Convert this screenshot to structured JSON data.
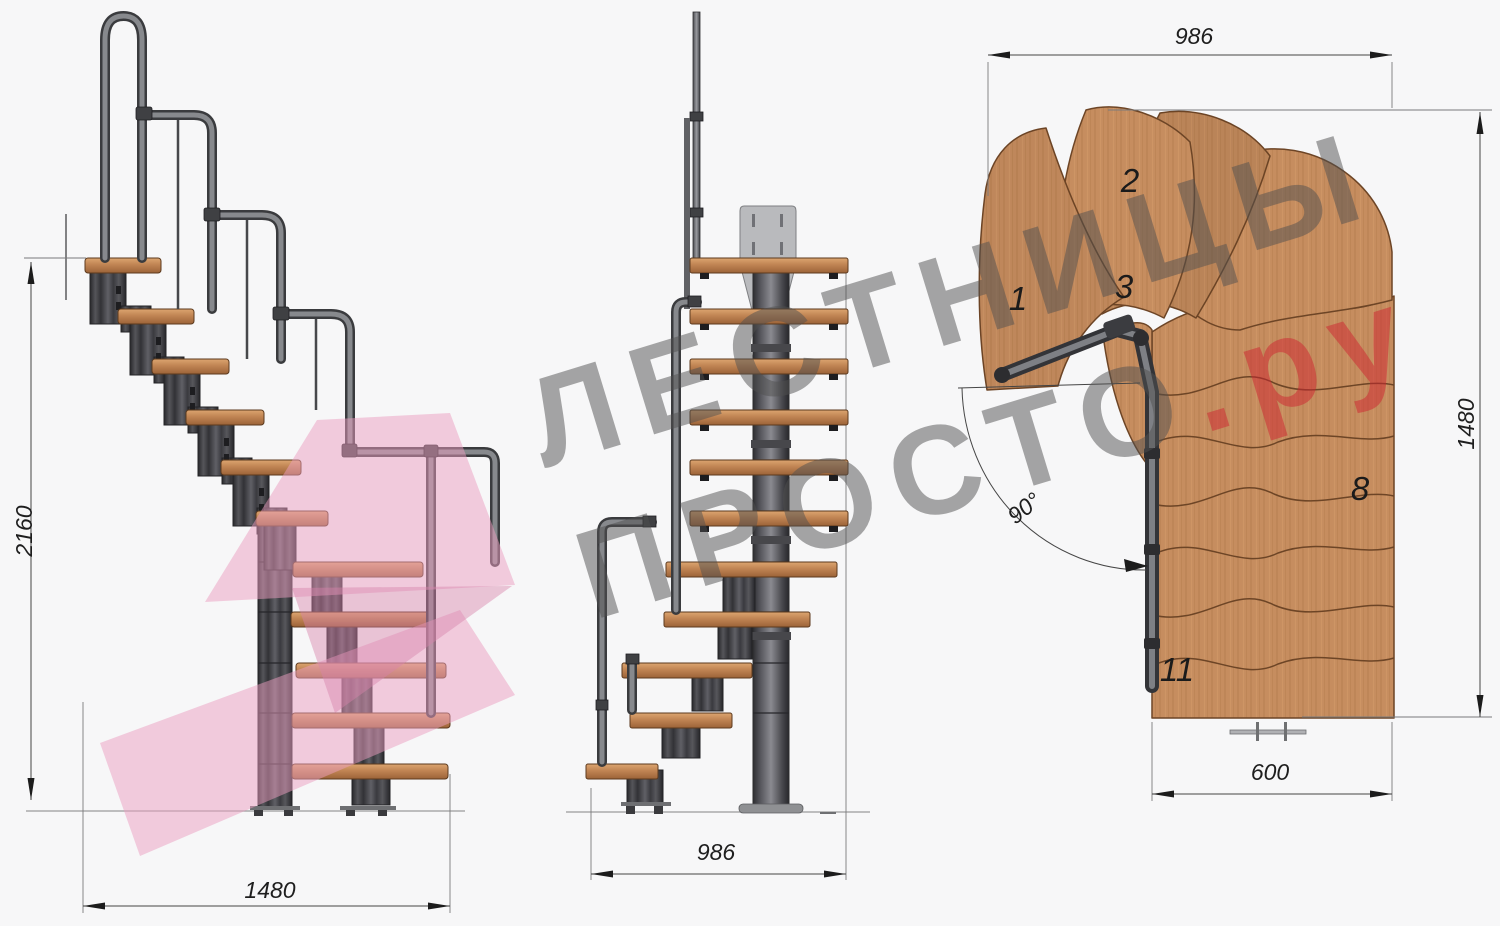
{
  "watermark": {
    "line1": "ЛЕСТНИЦЫ",
    "line2_gray": "ПРОСТО",
    "line2_red": ".ру"
  },
  "dims": {
    "side_height": "2160",
    "side_width": "1480",
    "front_width": "986",
    "plan_width": "986",
    "plan_depth": "1480",
    "plan_tread_width": "600",
    "turn_angle": "90°"
  },
  "plan_steps": {
    "n1": "1",
    "n2": "2",
    "n3": "3",
    "n8": "8",
    "n11": "11"
  },
  "colors": {
    "background": "#f7f7f8",
    "wood": "#c68d5f",
    "metal": "#4a4a4f",
    "handrail": "#87898d",
    "dimension_text": "#1e1e1e",
    "watermark_gray": "#787878",
    "watermark_red": "#cd2330",
    "logo_pink": "#ec9dc0"
  }
}
